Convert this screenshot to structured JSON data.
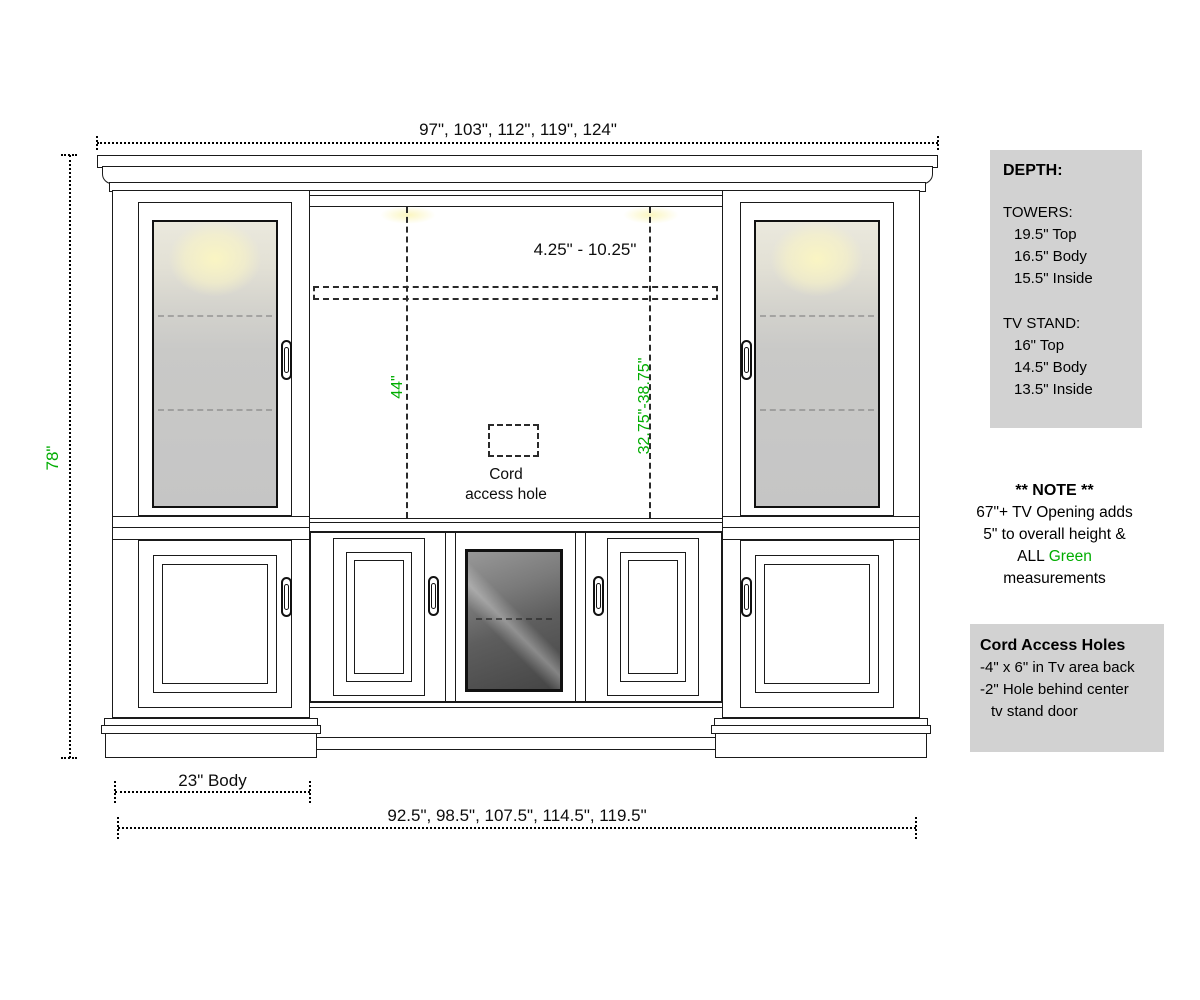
{
  "colors": {
    "dimension_green": "#00AD00",
    "panel_gray": "#d2d2d2",
    "glass_glow_yellow": "#faf5c3"
  },
  "dimensions": {
    "top_widths": "97\", 103\", 112\", 119\", 124\"",
    "overall_height": "78\"",
    "tv_opening_adjustable_range": "4.25\" - 10.25\"",
    "left_opening_height": "44\"",
    "tv_opening_height_range": "32.75\"-38.75\"",
    "tower_body_width": "23\" Body",
    "bottom_widths": "92.5\", 98.5\", 107.5\", 114.5\", 119.5\""
  },
  "cord_hole_label": {
    "line1": "Cord",
    "line2": "access hole"
  },
  "depth_panel": {
    "title": "DEPTH:",
    "towers_heading": "TOWERS:",
    "towers_lines": [
      "19.5\" Top",
      "16.5\" Body",
      "15.5\" Inside"
    ],
    "tv_stand_heading": "TV STAND:",
    "tv_stand_lines": [
      "16\" Top",
      "14.5\" Body",
      "13.5\" Inside"
    ]
  },
  "note_panel": {
    "title": "** NOTE **",
    "line1": "67\"+ TV Opening adds",
    "line2": "5\" to overall height &",
    "line3_black": "ALL",
    "line3_green": "Green",
    "line4": "measurements"
  },
  "cord_panel": {
    "title": "Cord Access Holes",
    "line1": "-4\" x 6\" in Tv area back",
    "line2": "-2\" Hole behind center",
    "line3": "tv stand door"
  }
}
